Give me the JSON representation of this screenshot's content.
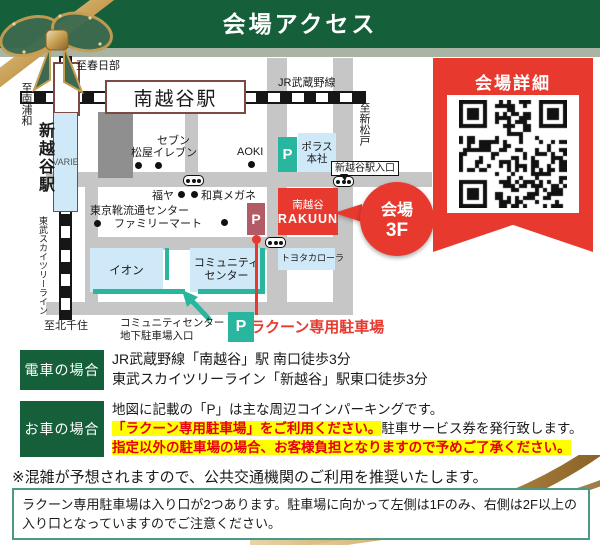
{
  "header": {
    "title": "会場アクセス"
  },
  "banner": {
    "title": "会場詳細"
  },
  "map": {
    "directions": {
      "kasukabe": "至春日部",
      "minami_urawa": "至南浦和",
      "shin_matsudo": "至新松戸",
      "kita_senju": "至北千住"
    },
    "stations": {
      "minami_koshigaya": "南越谷駅",
      "shin_koshigaya": "新越谷駅"
    },
    "lines": {
      "jr": "JR武蔵野線",
      "tobu": "東武スカイツリーライン"
    },
    "buildings": {
      "varie": "VARIE",
      "matsuya": "松屋",
      "seven_1": "セブン",
      "seven_2": "イレブン",
      "aoki": "AOKI",
      "fukuya": "福ヤ",
      "washin": "和真メガネ",
      "shoe_center": "東京靴流通センター",
      "familymart": "ファミリーマート",
      "polus_1": "ポラス",
      "polus_2": "本社",
      "rakuun_1": "南越谷",
      "rakuun_2": "RAKUUN",
      "toyota": "トヨタカローラ",
      "aeon": "イオン",
      "community_1": "コミュニティ",
      "community_2": "センター"
    },
    "labels": {
      "station_entrance": "新越谷駅入口",
      "venue_1": "会場",
      "venue_2": "3F",
      "rakuun_parking": "ラクーン専用駐車場",
      "ccenter_1": "コミュニティセンター",
      "ccenter_2": "地下駐車場入口",
      "parking_p": "P"
    }
  },
  "sections": {
    "train": {
      "label": "電車の場合",
      "line1": "JR武蔵野線「南越谷」駅 南口徒歩3分",
      "line2": "東武スカイツリーライン「新越谷」駅東口徒歩3分"
    },
    "car": {
      "label": "お車の場合",
      "seg1": "地図に記載の「P」は主な周辺コインパーキングです。",
      "seg2_hl": "「ラクーン専用駐車場」",
      "seg3_hl": "をご利用ください。",
      "seg4": "駐車サービス券を発行致します。",
      "seg5_hl": "指定以外の駐車場の場合、お客様負担となりますので予めご了承ください。"
    },
    "note": "※混雑が予想されますので、公共交通機関のご利用を推奨いたします。",
    "info_box": "ラクーン専用駐車場は入り口が2つあります。駐車場に向かって左側は1Fのみ、右側は2F以上の入り口となっていますのでご注意ください。"
  },
  "colors": {
    "green": "#15603a",
    "sage": "#a9b4a5",
    "red": "#e8392f",
    "teal": "#28b79e",
    "maroon": "#b25a66",
    "light_blue": "#cfe9f8",
    "road": "#c6c6c6",
    "highlight_bg": "#ffff00",
    "highlight_text": "#e60012"
  }
}
